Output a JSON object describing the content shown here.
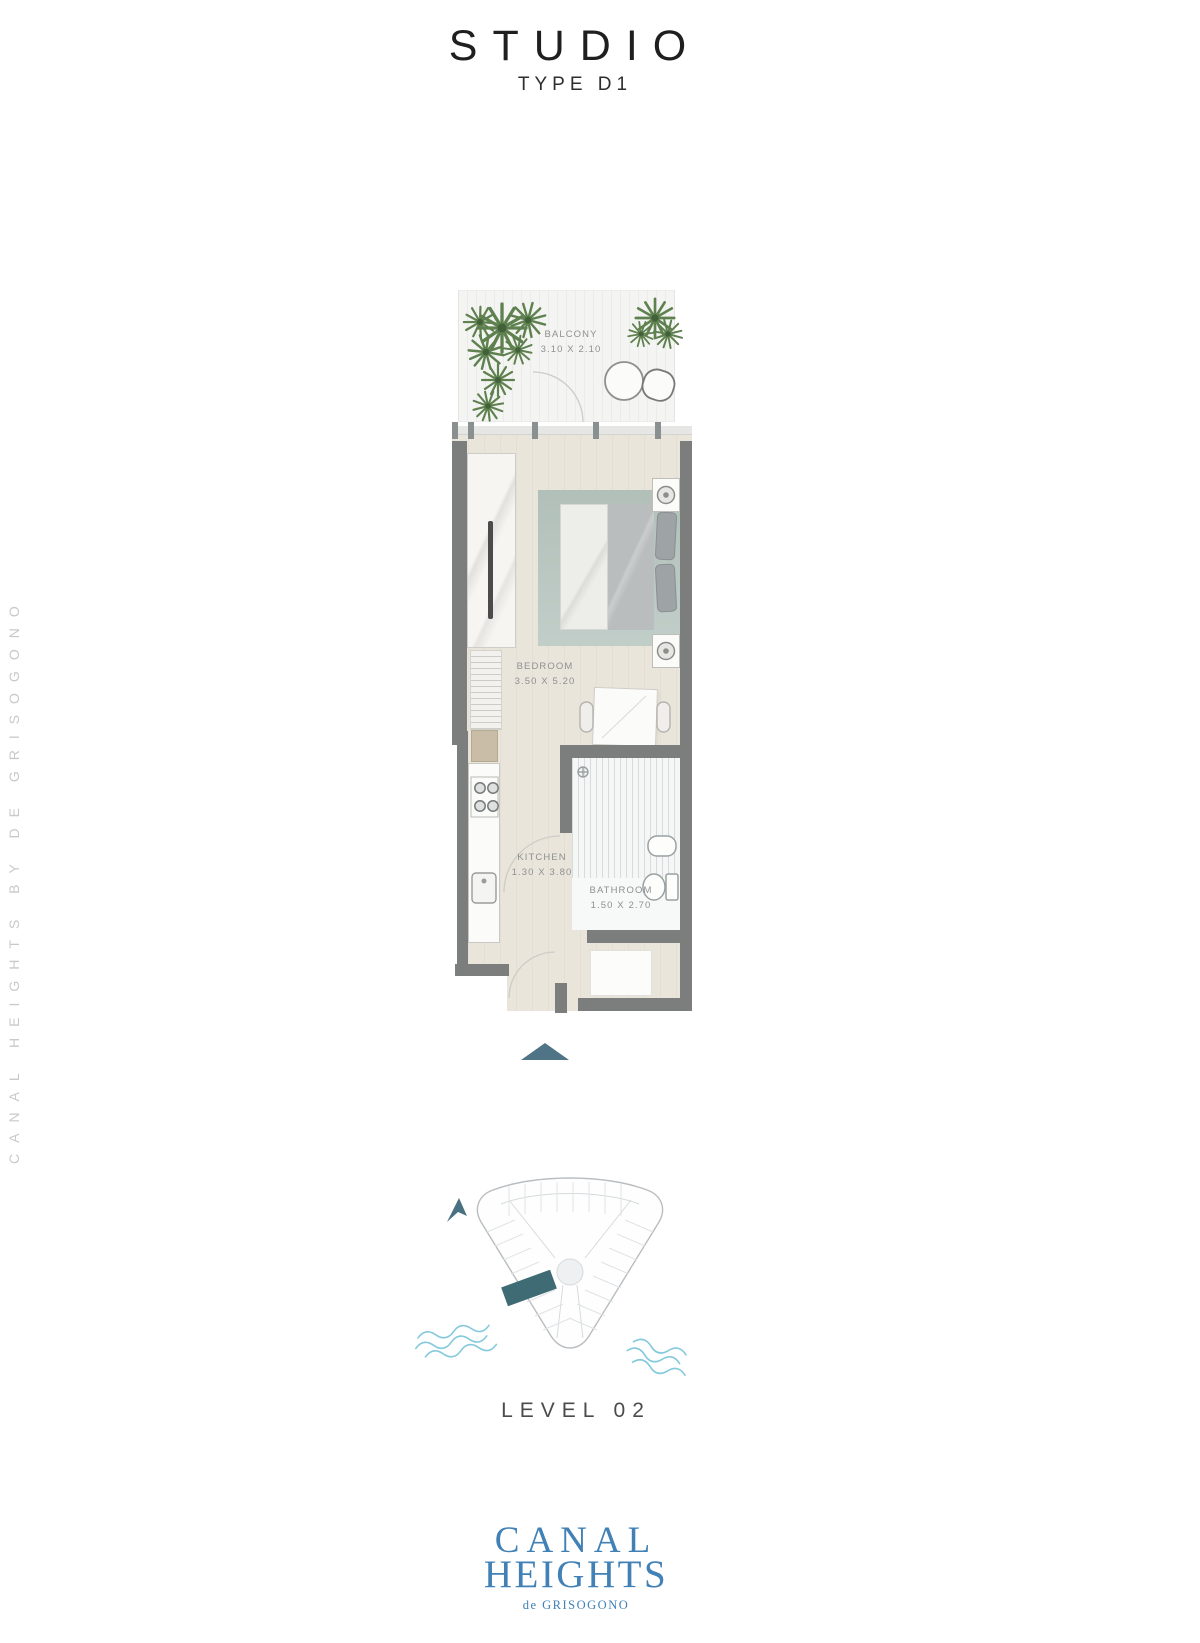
{
  "header": {
    "title": "STUDIO",
    "subtitle": "TYPE D1"
  },
  "watermark": {
    "text": "CANAL HEIGHTS BY DE GRISOGONO"
  },
  "floor_plan": {
    "rooms": [
      {
        "id": "balcony",
        "name": "BALCONY",
        "dimensions": "3.10 X 2.10"
      },
      {
        "id": "bedroom",
        "name": "BEDROOM",
        "dimensions": "3.50 X 5.20"
      },
      {
        "id": "kitchen",
        "name": "KITCHEN",
        "dimensions": "1.30 X 3.80"
      },
      {
        "id": "bathroom",
        "name": "BATHROOM",
        "dimensions": "1.50 X 2.70"
      }
    ]
  },
  "level_indicator": {
    "label": "LEVEL 02"
  },
  "brand": {
    "name_line1": "CANAL",
    "name_line2": "HEIGHTS",
    "byline": "de GRISOGONO"
  },
  "colors": {
    "logo_blue": "#4181b5",
    "wall_gray": "#7c7e7d",
    "accent_teal": "#4e7486",
    "highlight_unit_teal": "#3f6b74",
    "water_blue": "#85c9dc",
    "watermark_gray": "#c9c9c9"
  }
}
